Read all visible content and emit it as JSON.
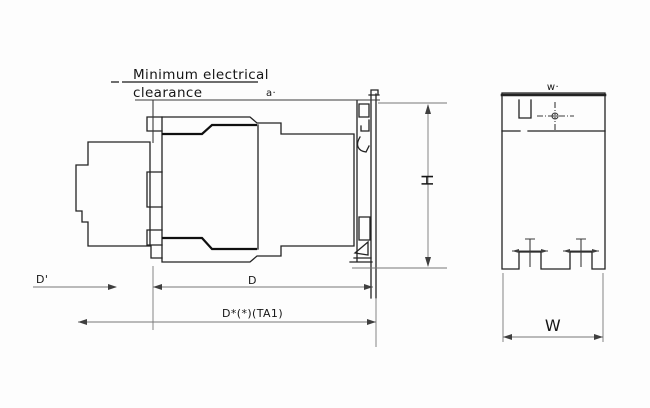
{
  "drawing": {
    "note": {
      "line1": "Minimum electrical",
      "line2": "clearance"
    },
    "side_view": {
      "clearance_label": "a·",
      "height_label": "H",
      "front_depth_label": "D'",
      "depth_label": "D",
      "total_depth_label": "D*(*)(TA1)"
    },
    "front_view": {
      "top_width_label": "w·",
      "width_label": "W"
    },
    "colors": {
      "background": "#fdfdfd",
      "object_line": "#232323",
      "dimension_line": "#787878",
      "text": "#161616"
    }
  }
}
